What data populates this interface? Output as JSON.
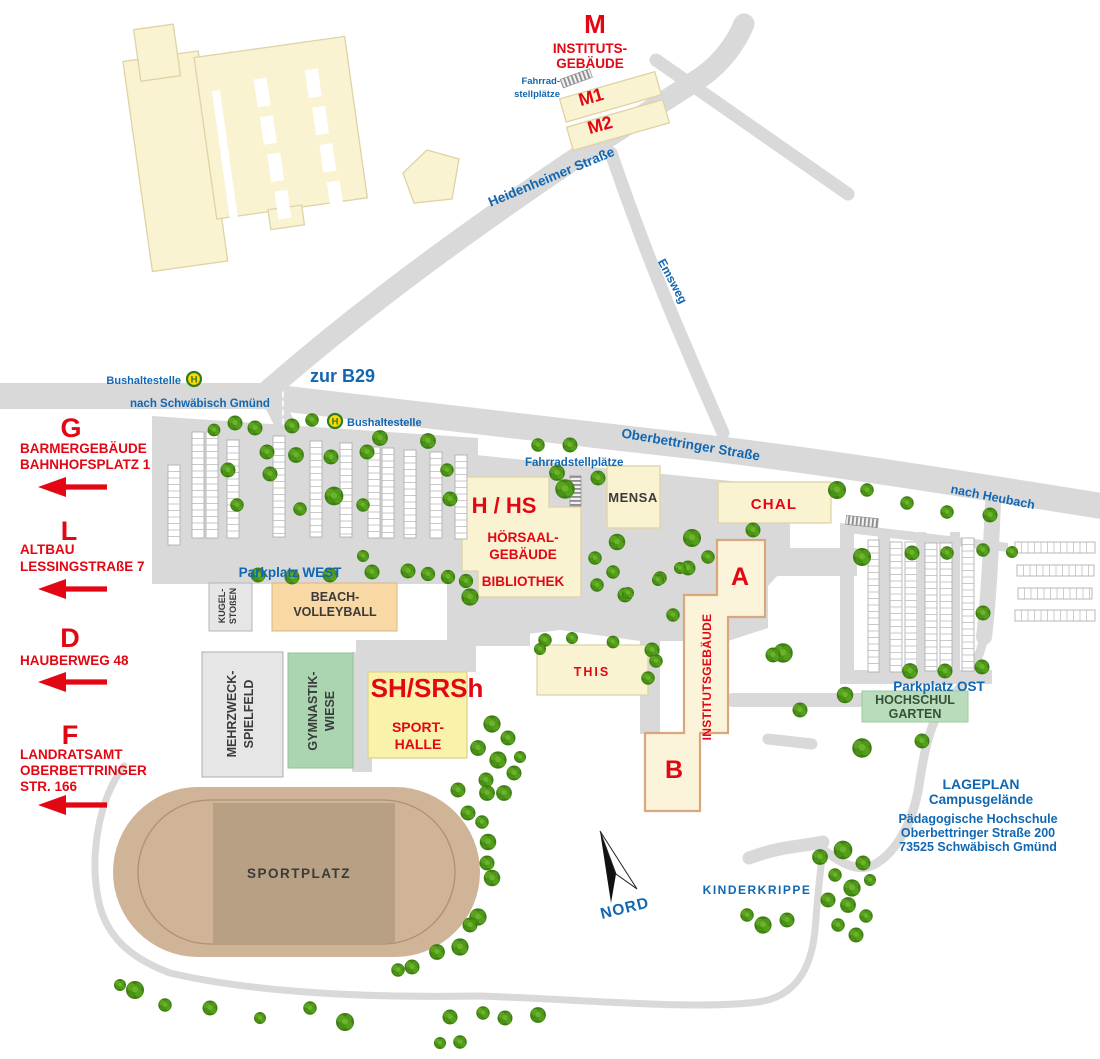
{
  "colors": {
    "accent_red": "#e30613",
    "label_blue": "#1167b2",
    "road_gray": "#d9d9d9",
    "building_cream": "#faf3d2",
    "institute_outline": "#d8a87c",
    "sporthalle_yellow": "#f9f2ab",
    "tree_green": "#4f9719",
    "sand_light": "#cfb497",
    "sand_dark": "#b7a083",
    "beach_orange": "#f8d8a4",
    "field_green": "#abd5b0",
    "bus_green": "#2e7d1f",
    "bus_yellow": "#ffd800"
  },
  "legend": {
    "title": "LAGEPLAN",
    "subtitle": "Campusgelände",
    "org": "Pädagogische Hochschule",
    "street": "Oberbettringer Straße 200",
    "city": "73525 Schwäbisch Gmünd"
  },
  "compass": {
    "north": "NORD"
  },
  "streets": {
    "heidenheimer": "Heidenheimer Straße",
    "emsweg": "Emsweg",
    "oberbettringer": "Oberbettringer Straße",
    "zur_b29": "zur B29",
    "nach_schwaebisch_gmuend": "nach Schwäbisch Gmünd",
    "nach_heubach": "nach Heubach"
  },
  "transit": {
    "bus_stop_west": "Bushaltestelle",
    "bus_stop_center": "Bushaltestelle",
    "h_symbol": "H"
  },
  "bike": {
    "top_line1": "Fahrrad-",
    "top_line2": "stellplätze",
    "central": "Fahrradstellplätze"
  },
  "parking": {
    "west": "Parkplatz WEST",
    "ost": "Parkplatz OST"
  },
  "buildings": {
    "m": {
      "code": "M",
      "name_line1": "INSTITUTS-",
      "name_line2": "GEBÄUDE",
      "wing1": "M1",
      "wing2": "M2"
    },
    "hhs": {
      "code": "H / HS",
      "name_line1": "HÖRSAAL-",
      "name_line2": "GEBÄUDE",
      "library": "BIBLIOTHEK"
    },
    "mensa": "MENSA",
    "chal": "CHAL",
    "institute": {
      "block_a": "A",
      "block_b": "B",
      "name": "INSTITUTSGEBÄUDE"
    },
    "this": "THIS",
    "sporthalle": {
      "code": "SH/SRSh",
      "name_line1": "SPORT-",
      "name_line2": "HALLE"
    },
    "hochschulgarten": {
      "line1": "HOCHSCHUL",
      "line2": "GARTEN"
    },
    "kinderkrippe": "KINDERKRIPPE"
  },
  "sports": {
    "sportplatz": "SPORTPLATZ",
    "beach": {
      "line1": "BEACH-",
      "line2": "VOLLEYBALL"
    },
    "gymnastik": {
      "line1": "GYMNASTIK-",
      "line2": "WIESE"
    },
    "mehrzweck": {
      "line1": "MEHRZWECK-",
      "line2": "SPIELFELD"
    },
    "kugelstossen": {
      "line1": "KUGEL-",
      "line2": "STOßEN"
    }
  },
  "directions": [
    {
      "letter": "G",
      "lines": [
        "BARMERGEBÄUDE",
        "BAHNHOFSPLATZ 1"
      ]
    },
    {
      "letter": "L",
      "lines": [
        "ALTBAU",
        "LESSINGSTRAßE 7"
      ]
    },
    {
      "letter": "D",
      "lines": [
        "HAUBERWEG 48"
      ]
    },
    {
      "letter": "F",
      "lines": [
        "LANDRATSAMT",
        "OBERBETTRINGER",
        "STR. 166"
      ]
    }
  ]
}
